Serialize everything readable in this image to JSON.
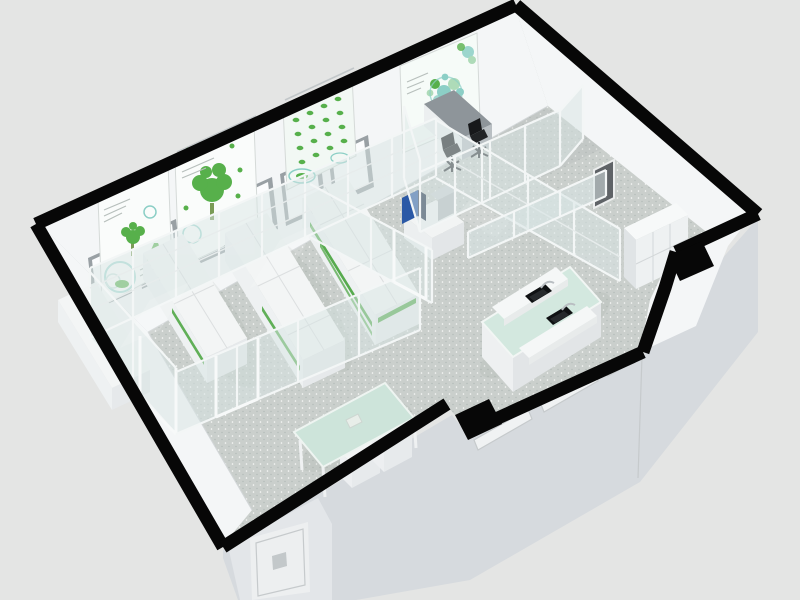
{
  "meta": {
    "title": "3D isometric cutaway render of a laboratory floor plan",
    "description": "Architectural visualization: black-outlined lab floor plan with glass partition rooms, white plant-culture benches and grow racks, botanical wall posters, office corner with two chairs, sink island bench with mint top, mint meeting table, speckled gray resin floor."
  },
  "palette": {
    "background": "#e4e5e4",
    "wall_black": "#070707",
    "floor": "#cacfcc",
    "speckle_light": "#ffffff",
    "speckle_dark": "#a9b1ae",
    "wall_white": "#f4f6f7",
    "exterior_face": "#d6dade",
    "exterior_face_light": "#e3e6e9",
    "glass": "#d9e6e5",
    "island_top": "#d3e8df",
    "table_top": "#cde4da",
    "plant_green": "#46a33c",
    "poster_bg": "#fafcfb",
    "poster_teal": "#8ccfc6",
    "poster_green": "#57b04b",
    "window_pane": "#fbfcfd",
    "window_frame": "#99a0a4",
    "equipment_blue": "#2b59a6",
    "desk_gray": "#8e959a",
    "chair_black": "#17181a",
    "sink_black": "#0f1113",
    "dark_door": "#5f6367"
  },
  "scene": {
    "objects": [
      "perimeter-wall-cut",
      "speckled-floor",
      "glass-partitions",
      "botanical-posters",
      "window-row",
      "plant-benches",
      "grow-racks",
      "office-desk",
      "office-chairs",
      "instrument-bench",
      "sink-island-bench",
      "meeting-table",
      "wall-cabinets",
      "exterior-door",
      "service-door"
    ]
  }
}
